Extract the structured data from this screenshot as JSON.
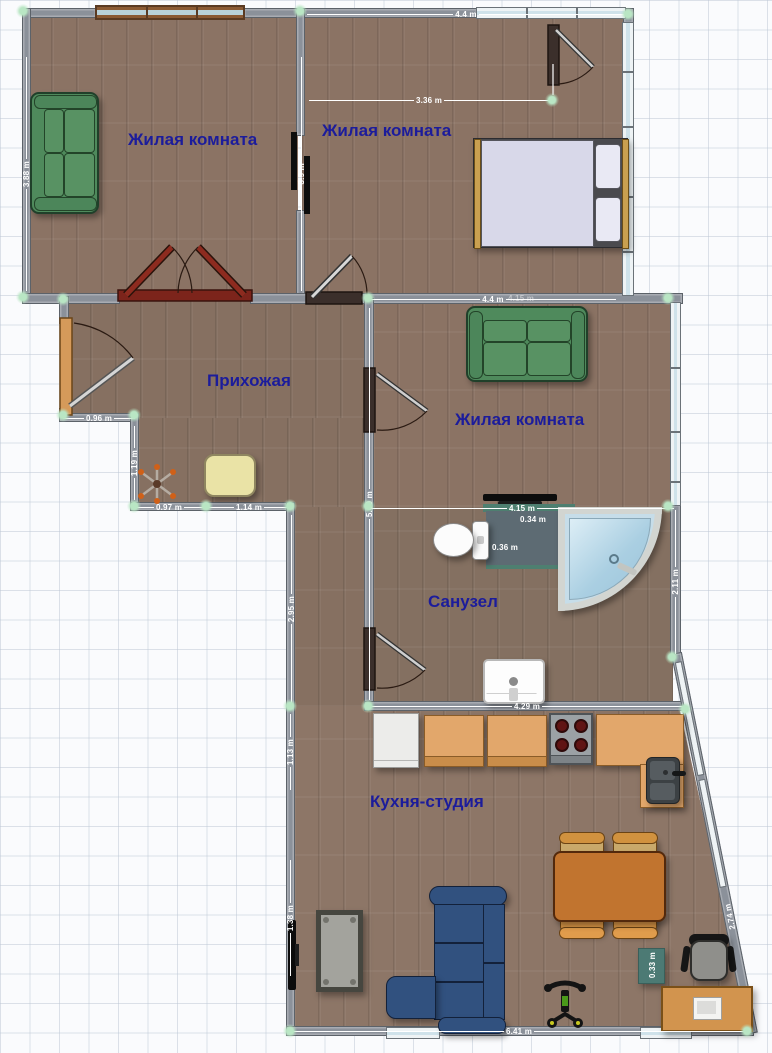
{
  "rooms": {
    "living1": {
      "label": "Жилая комната"
    },
    "living2": {
      "label": "Жилая комната"
    },
    "living3": {
      "label": "Жилая комната"
    },
    "hallway": {
      "label": "Прихожая"
    },
    "bathroom": {
      "label": "Санузел"
    },
    "kitchen": {
      "label": "Кухня-студия"
    }
  },
  "dims": {
    "r2_top": "4.4 m",
    "r1_left": "3.88 m",
    "divider": "3.9 m",
    "r2_inner": "3.36 m",
    "r3_top": "4.4 m",
    "r3_top2": "4.15 m",
    "r3_left": "5.69 m",
    "hall_w": "0.96 m",
    "hall_h": "1.19 m",
    "hall_b1": "0.97 m",
    "hall_b2": "1.14 m",
    "corridor": "2.95 m",
    "bath_top": "4.15 m",
    "plat_w": "0.34 m",
    "plat_d": "0.36 m",
    "bath_right": "2.11 m",
    "bath_bottom": "4.29 m",
    "kitchen_l1": "1.13 m",
    "kitchen_l2": "1.38 m",
    "kitchen_bottom": "6.41 m",
    "diag": "2.74 m",
    "desk_block": "0.33 m"
  },
  "colors": {
    "wall": "#8b919a",
    "room_label": "#1c1c9b",
    "floor_wood": "#8b7364",
    "dimension_text": "#ffffff",
    "handle_green": "#b9e6c4",
    "sofa_green": "#4f8a5c",
    "sofa_blue": "#31517f",
    "door_red": "#7c241b",
    "cabinet_tan": "#e2a76b",
    "shower_blue": "#bad6e6"
  }
}
